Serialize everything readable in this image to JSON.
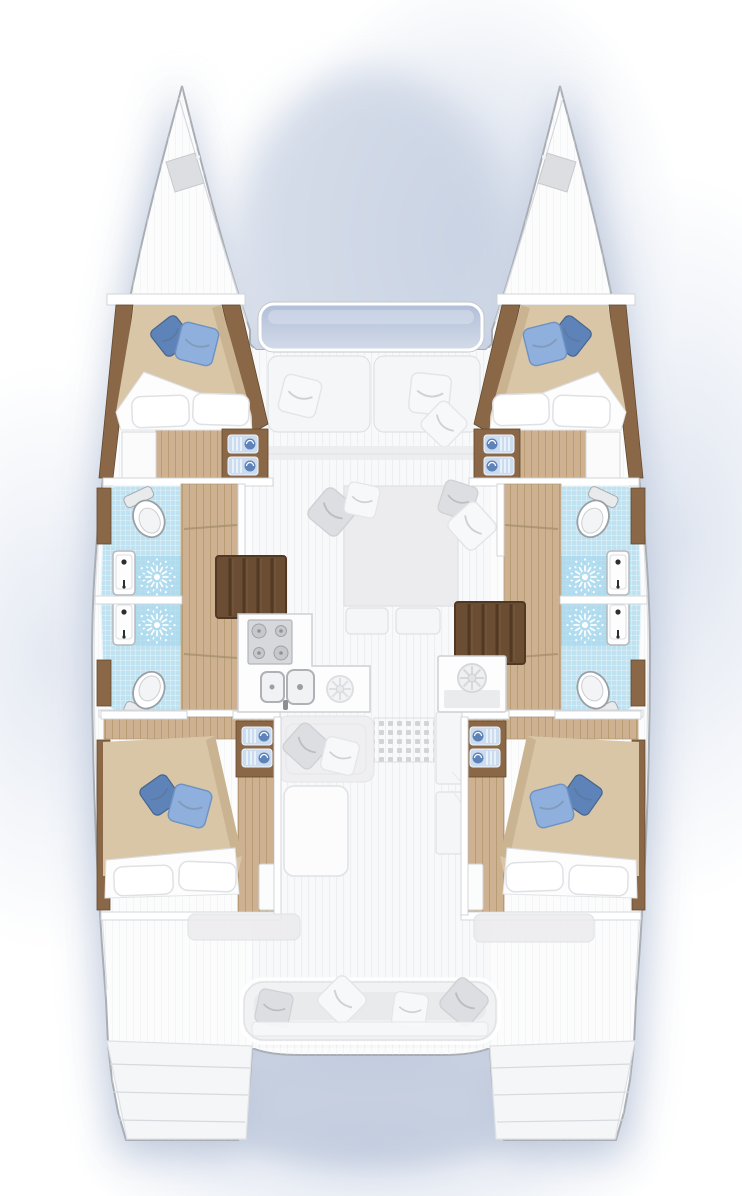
{
  "scene": {
    "type": "boat-floorplan",
    "subject": "catamaran sailing yacht interior layout, top-down view",
    "visible_text": "",
    "levels": {
      "solid_lower_deck": "four double cabins, four bathrooms, galley, two stair flights",
      "ghosted_main_deck": "saloon sofa and table, forward seat, aft cockpit bench, helm console"
    }
  },
  "inventory": {
    "hulls": 2,
    "double_cabins": 4,
    "double_beds": 4,
    "bed_pillows_white_per_bed": 2,
    "bed_pillows_blue_per_bed": 2,
    "bathrooms": 4,
    "showers": 4,
    "toilets": 4,
    "bathroom_sinks": 4,
    "towel_shelves": 4,
    "stair_flights": 2,
    "galley_cooktop_burners": 4,
    "galley_sinks": 2,
    "front_loading_appliance": 1,
    "saloon_table": 1,
    "cockpit_bench": 1,
    "bow_hatches": 2,
    "swim_platforms": 2
  },
  "colors": {
    "hullFill": "#fcfcfd",
    "hullStroke": "#a9aeb5",
    "line": "#cfd2d6",
    "shadow": "#b5c1d7",
    "woodFloor": "#cdb190",
    "woodPlank": "#b89c74",
    "woodTrim": "#8a6847",
    "woodTrimDark": "#63492f",
    "stairs": "#6b4d33",
    "stairsTread": "#4e3621",
    "blanket": "#d9c6a7",
    "blanketShade": "#c6ae8c",
    "pillowDark": "#5d83b8",
    "pillowLight": "#8fb0dc",
    "tile": "#bfe2f1",
    "tileShower": "#a4d7ec",
    "towel": "#ccdcf0",
    "ghost": "#ececee",
    "ghostLine": "#dfe1e4",
    "window": "#c0cce0",
    "appliance": "#d6d8db"
  }
}
